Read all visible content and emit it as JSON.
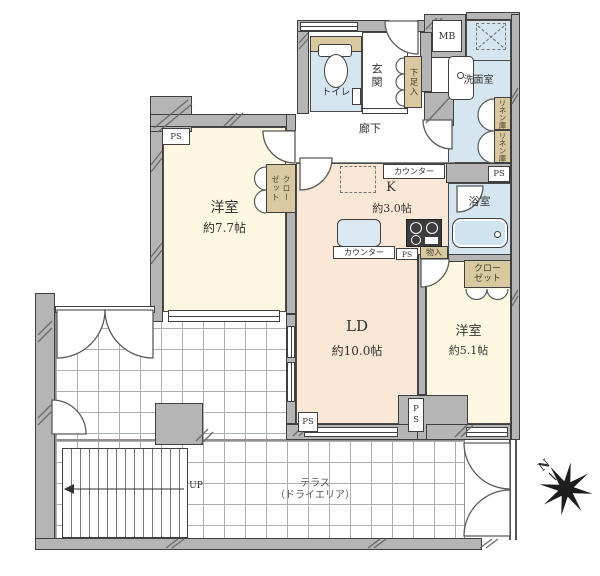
{
  "floorplan": {
    "rooms": {
      "western1": {
        "name": "洋室",
        "area": "約7.7帖"
      },
      "living_dining": {
        "name": "LD",
        "area": "約10.0帖"
      },
      "western2": {
        "name": "洋室",
        "area": "約5.1帖"
      },
      "kitchen": {
        "name": "K",
        "area": "約3.0帖"
      },
      "hallway": "廊下",
      "entrance": "玄関",
      "toilet": "トイレ",
      "washroom": "洗面室",
      "bathroom": "浴室",
      "terrace_line1": "テラス",
      "terrace_line2": "（ドライエリア）"
    },
    "storage": {
      "closet_full": "クローゼット",
      "closet_line1": "クロー",
      "closet_line2": "ゼット",
      "shoe_cabinet": "下足入",
      "linen": "リネン庫",
      "small_storage": "物入"
    },
    "labels": {
      "counter": "カウンター",
      "meter_box": "MB",
      "pipe_space": "PS",
      "up": "UP",
      "north": "N"
    },
    "colors": {
      "room_cream": "#fdf8e1",
      "room_peach": "#fae7d5",
      "room_blue": "#d5e6f1",
      "storage_tan": "#d9c9a0",
      "wall_gray": "#b5b5b5"
    }
  }
}
